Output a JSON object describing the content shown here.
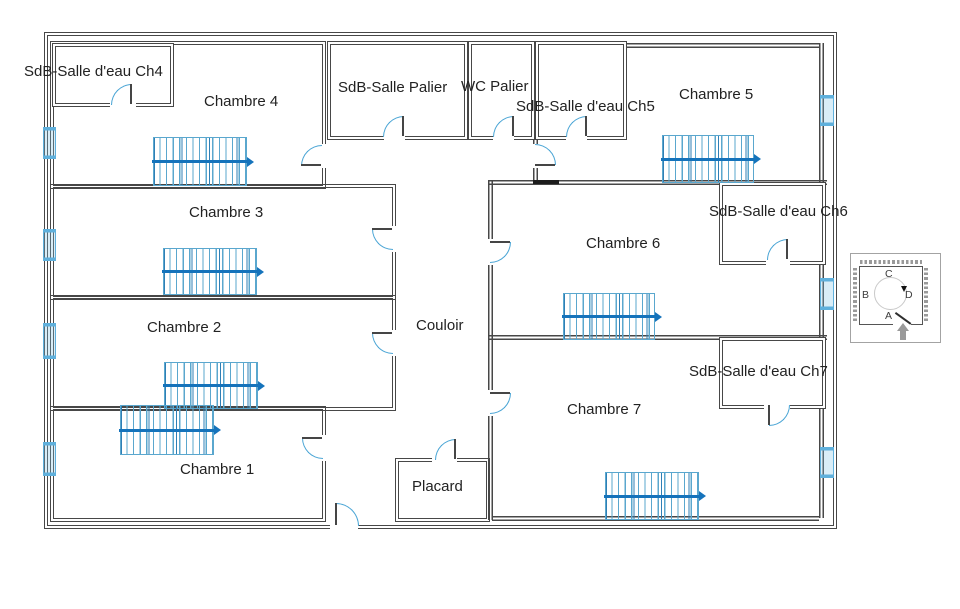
{
  "plan": {
    "rooms": [
      {
        "id": "sdb-ch4",
        "label": "SdB-Salle d'eau Ch4"
      },
      {
        "id": "chambre-4",
        "label": "Chambre 4"
      },
      {
        "id": "sdb-palier",
        "label": "SdB-Salle Palier"
      },
      {
        "id": "wc-palier",
        "label": "WC Palier"
      },
      {
        "id": "sdb-ch5",
        "label": "SdB-Salle d'eau Ch5"
      },
      {
        "id": "chambre-5",
        "label": "Chambre 5"
      },
      {
        "id": "chambre-3",
        "label": "Chambre 3"
      },
      {
        "id": "sdb-ch6",
        "label": "SdB-Salle d'eau Ch6"
      },
      {
        "id": "chambre-6",
        "label": "Chambre 6"
      },
      {
        "id": "chambre-2",
        "label": "Chambre 2"
      },
      {
        "id": "couloir",
        "label": "Couloir"
      },
      {
        "id": "chambre-1",
        "label": "Chambre 1"
      },
      {
        "id": "placard",
        "label": "Placard"
      },
      {
        "id": "chambre-7",
        "label": "Chambre 7"
      },
      {
        "id": "sdb-ch7",
        "label": "SdB-Salle d'eau Ch7"
      }
    ],
    "inset": {
      "letter_top": "C",
      "letter_left": "B",
      "letter_right": "D",
      "letter_bottom": "A"
    },
    "colors": {
      "wall": "#474747",
      "door_arc": "#4aa5d5",
      "window": "#5fb0dc",
      "radiator_line": "#5aa7ce",
      "radiator_arrow": "#1573bb",
      "text": "#222222"
    }
  }
}
